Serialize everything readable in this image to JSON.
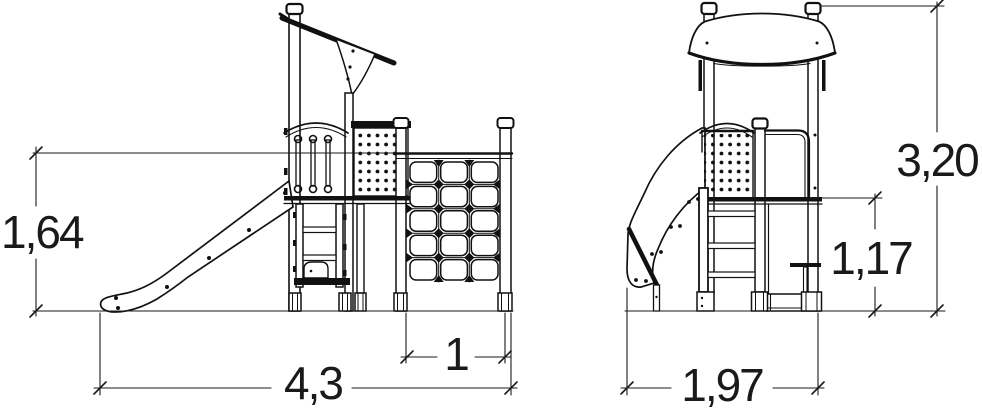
{
  "colors": {
    "background": "#ffffff",
    "line": "#111111",
    "dimension": "#1a1a1a"
  },
  "views": {
    "side": {
      "dimensions": {
        "rail_height": "1,64",
        "overall_length": "4,3",
        "net_width": "1"
      }
    },
    "front": {
      "dimensions": {
        "overall_height": "3,20",
        "platform_height": "1,17",
        "overall_width": "1,97"
      }
    }
  }
}
